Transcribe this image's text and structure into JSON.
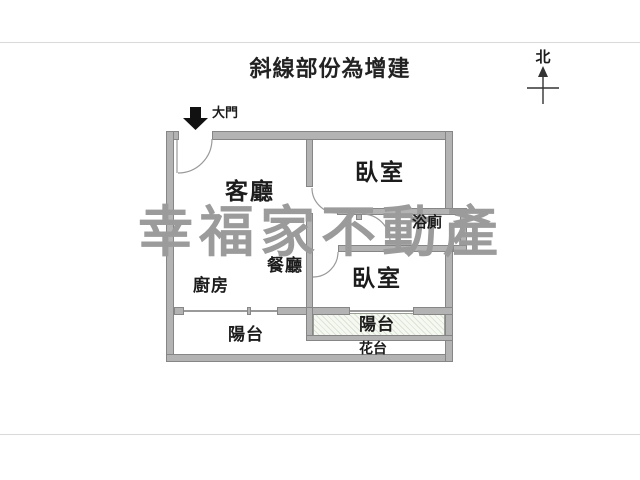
{
  "header": {
    "title": "斜線部份為增建"
  },
  "compass": {
    "label": "北"
  },
  "entrance": {
    "label": "大門"
  },
  "rooms": {
    "living": "客廳",
    "bedroom1": "臥室",
    "bathroom": "浴廁",
    "dining": "餐廳",
    "kitchen": "廚房",
    "bedroom2": "臥室",
    "balcony_left": "陽台",
    "balcony_right": "陽台",
    "flower_bed": "花台"
  },
  "watermark": {
    "text": "幸福家不動產"
  },
  "colors": {
    "wall_fill": "#b3b3b3",
    "wall_border": "#868686",
    "watermark_gray": "#9b9b9b",
    "hatch_line": "#dde3d6",
    "frame_line": "#d9d9d9",
    "label_text": "#1c1c1c"
  }
}
